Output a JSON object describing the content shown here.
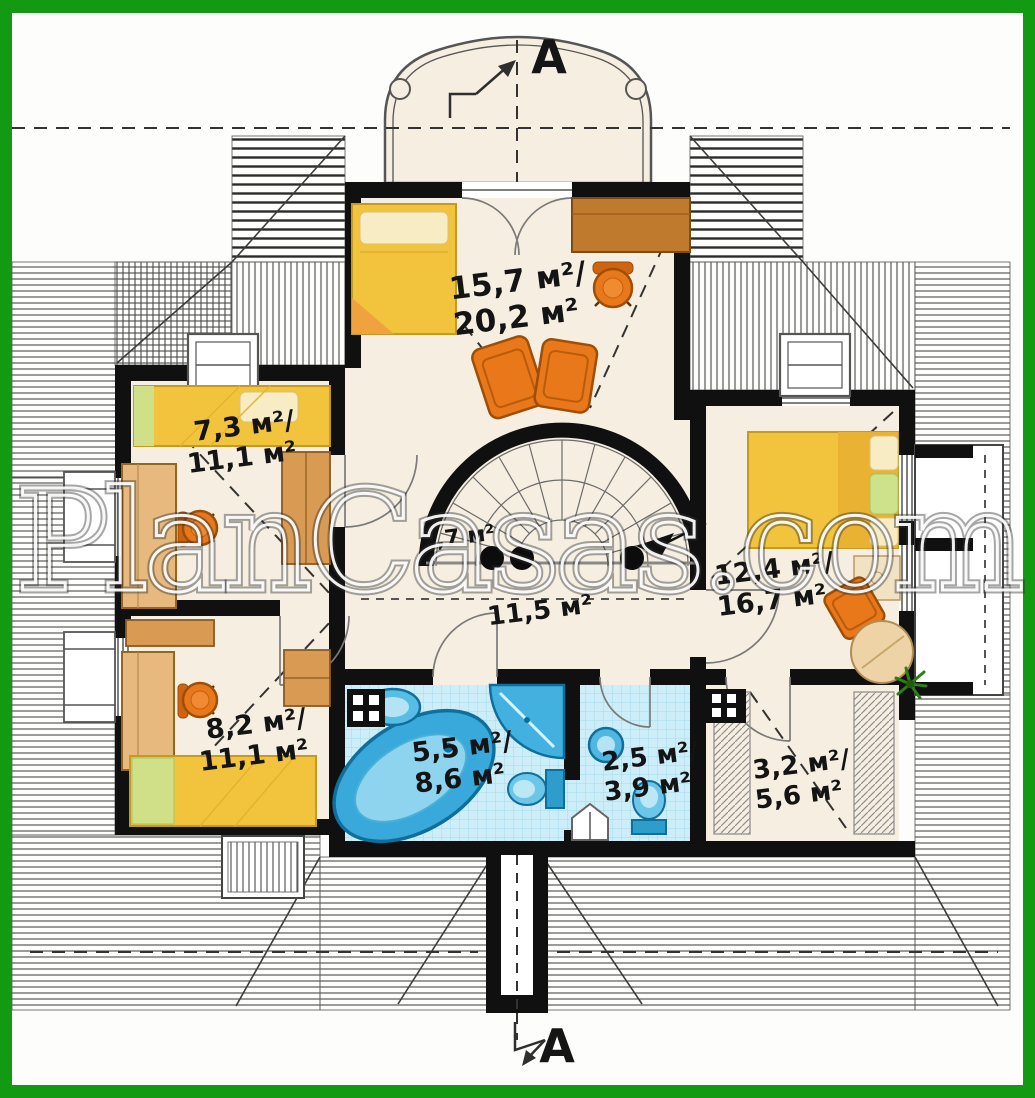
{
  "watermark": {
    "text": "PlanCasas.com"
  },
  "section_markers": {
    "top": "A",
    "bottom": "A"
  },
  "rooms": [
    {
      "id": "top-bedroom",
      "area_line1": "15,7 м²/",
      "area_line2": "20,2 м²"
    },
    {
      "id": "left-top-room",
      "area_line1": "7,3 м²/",
      "area_line2": "11,1 м²"
    },
    {
      "id": "right-bedroom",
      "area_line1": "12,4 м²/",
      "area_line2": "16,7 м²"
    },
    {
      "id": "hall",
      "area_line1": "11,5 м²"
    },
    {
      "id": "stair-closet",
      "area_line1": "2,7 м²"
    },
    {
      "id": "left-bottom-room",
      "area_line1": "8,2 м²/",
      "area_line2": "11,1 м²"
    },
    {
      "id": "bathroom",
      "area_line1": "5,5 м²/",
      "area_line2": "8,6 м²"
    },
    {
      "id": "wc",
      "area_line1": "2,5 м²/",
      "area_line2": "3,9 м²"
    },
    {
      "id": "wardrobe",
      "area_line1": "3,2 м²/",
      "area_line2": "5,6 м²"
    }
  ],
  "colors": {
    "frame_green": "#129a12",
    "wall_black": "#101010",
    "floor_cream": "#f6efe1",
    "tile_blue": "#cdeef8",
    "fixture_blue": "#3fb0dc",
    "bed_yellow": "#f2c33d",
    "furniture_orange": "#e8781a",
    "wood_tan": "#d99b53",
    "roof_hatch_gray": "#4a4a4a"
  }
}
